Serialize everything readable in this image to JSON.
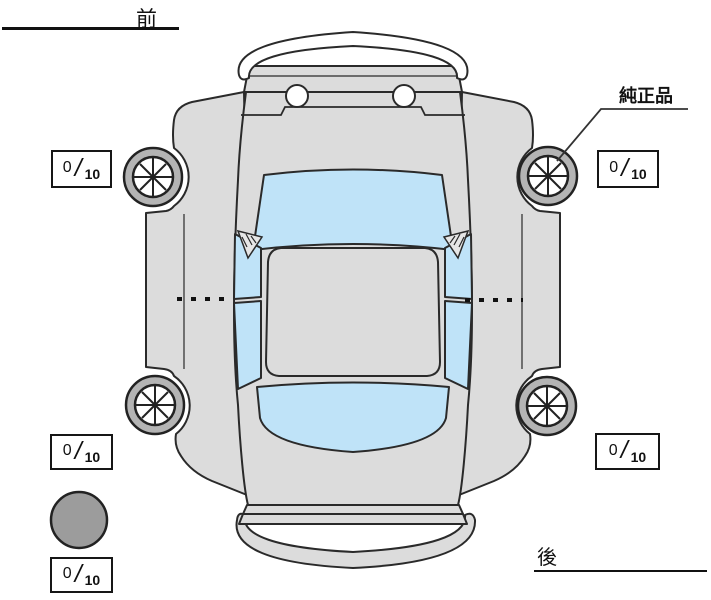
{
  "labels": {
    "front": "前",
    "rear": "後",
    "genuine_part": "純正品"
  },
  "tread_scores": {
    "front_left": {
      "value": "0",
      "separator": "/",
      "max": "10"
    },
    "front_right": {
      "value": "0",
      "separator": "/",
      "max": "10"
    },
    "rear_left": {
      "value": "0",
      "separator": "/",
      "max": "10"
    },
    "rear_right": {
      "value": "0",
      "separator": "/",
      "max": "10"
    },
    "spare": {
      "value": "0",
      "separator": "/",
      "max": "10"
    }
  },
  "colors": {
    "body": "#dcdcdc",
    "glass": "#bfe3f8",
    "tire": "#b4b4b4",
    "outline": "#2a2a2a",
    "spare_tire": "#9c9c9c",
    "text": "#111111"
  }
}
